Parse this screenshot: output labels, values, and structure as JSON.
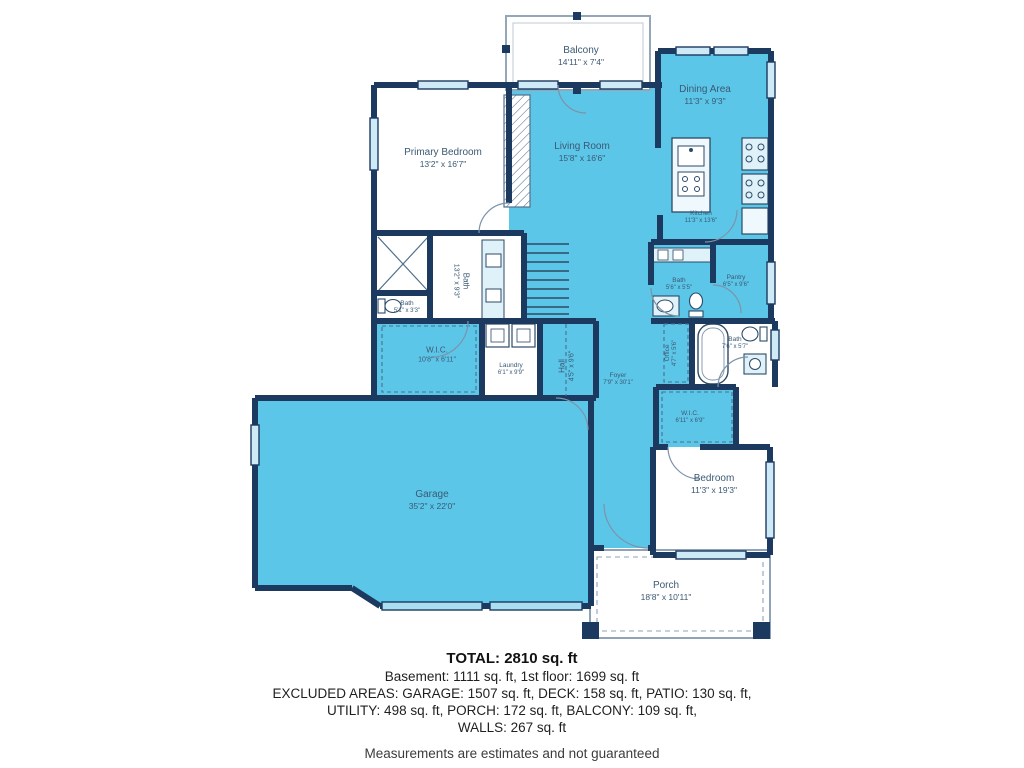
{
  "colors": {
    "wall": "#1c3a5f",
    "floor_blue": "#5cc6e8",
    "fixture_light": "#dff2fa",
    "window_fill": "#cdeaf6",
    "garage_door": "#aadff2",
    "room_white": "#ffffff",
    "label_text": "#3a5a74",
    "porch_outline": "#8fa3b8"
  },
  "rooms": {
    "balcony": {
      "name": "Balcony",
      "dims": "14'11\" x 7'4\""
    },
    "primary_bedroom": {
      "name": "Primary Bedroom",
      "dims": "13'2\" x 16'7\""
    },
    "living_room": {
      "name": "Living Room",
      "dims": "15'8\" x 16'6\""
    },
    "dining_area": {
      "name": "Dining Area",
      "dims": "11'3\" x 9'3\""
    },
    "kitchen": {
      "name": "Kitchen",
      "dims": "11'3\" x 13'6\""
    },
    "bath_main": {
      "name": "Bath",
      "dims": "13'2\" x 9'3\""
    },
    "bath_small": {
      "name": "Bath",
      "dims": "5'1\" x 3'3\""
    },
    "bath_upper": {
      "name": "Bath",
      "dims": "5'6\" x 5'5\""
    },
    "pantry": {
      "name": "Pantry",
      "dims": "6'5\" x 9'6\""
    },
    "wic_left": {
      "name": "W.I.C.",
      "dims": "10'8\" x 6'11\""
    },
    "laundry": {
      "name": "Laundry",
      "dims": "6'1\" x 9'9\""
    },
    "hall": {
      "name": "Hall",
      "dims": "4'5\" x 9'6\""
    },
    "foyer": {
      "name": "Foyer",
      "dims": "7'9\" x 30'1\""
    },
    "office": {
      "name": "Office",
      "dims": "4'7\" x 5'6\""
    },
    "bath_right": {
      "name": "Bath",
      "dims": "7'6\" x 5'7\""
    },
    "wic_right": {
      "name": "W.I.C.",
      "dims": "6'11\" x 6'9\""
    },
    "garage": {
      "name": "Garage",
      "dims": "35'2\" x 22'0\""
    },
    "bedroom": {
      "name": "Bedroom",
      "dims": "11'3\" x 19'3\""
    },
    "porch": {
      "name": "Porch",
      "dims": "18'8\" x 10'11\""
    }
  },
  "summary": {
    "total": "TOTAL: 2810 sq. ft",
    "line1": "Basement: 1111 sq. ft, 1st floor: 1699 sq. ft",
    "line2": "EXCLUDED AREAS: GARAGE: 1507 sq. ft, DECK: 158 sq. ft, PATIO: 130 sq. ft,",
    "line3": "UTILITY: 498 sq. ft, PORCH: 172 sq. ft, BALCONY: 109 sq. ft,",
    "line4": "WALLS: 267 sq. ft",
    "disclaimer": "Measurements are estimates and not guaranteed"
  }
}
